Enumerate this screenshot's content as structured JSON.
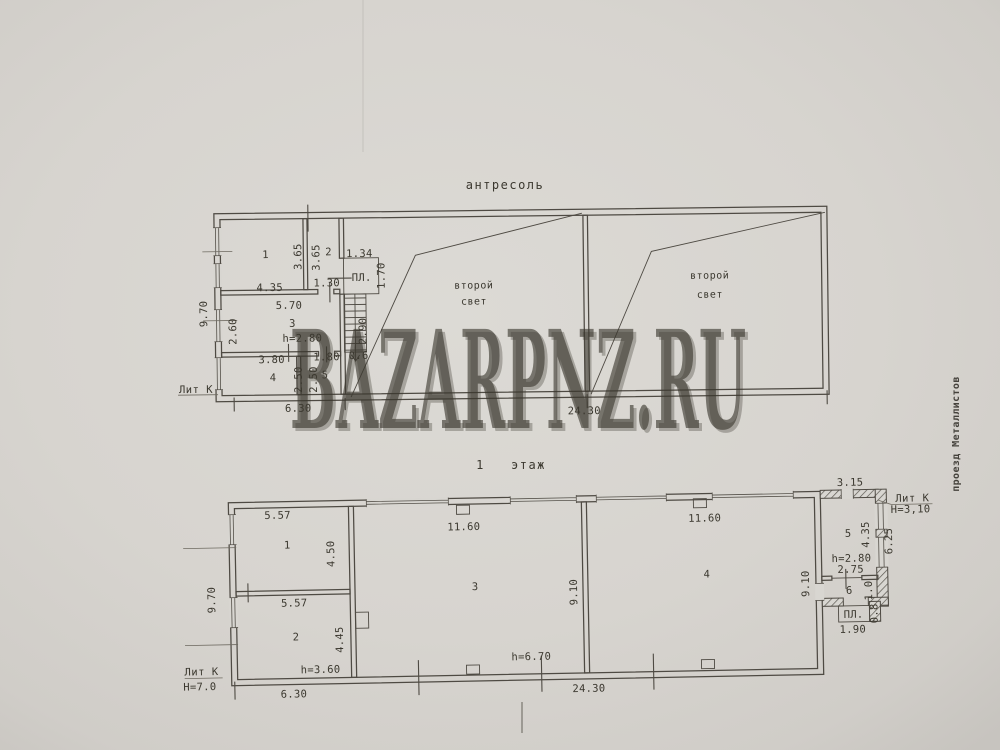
{
  "watermark": "BAZARPNZ.RU",
  "street_label": "проезд Металлистов",
  "mezzanine": {
    "title": "антресоль",
    "lit": "Лит К",
    "pl_label": "ПЛ.",
    "area1_line1": "второй",
    "area1_line2": "свет",
    "area2_line1": "второй",
    "area2_line2": "свет",
    "rooms": {
      "r1": "1",
      "r2": "2",
      "r3": "3",
      "r4": "4",
      "r5": "5"
    },
    "dims": {
      "left_height": "9.70",
      "bottom_left": "6.30",
      "bottom_right": "24.30",
      "r1_w": "4.35",
      "r1_h": "3.65",
      "r2_h": "3.65",
      "r2_w": "1.30",
      "pl_w": "1.34",
      "pl_h": "1.70",
      "stair_h": "2.90",
      "stair_w": "0.6",
      "r3_w": "5.70",
      "r3_d": "2.60",
      "r3_ceil": "h=2.80",
      "r4_w": "3.80",
      "r4_d": "2.50",
      "r5_w": "1.80",
      "r5_d": "2.50"
    }
  },
  "first_floor": {
    "title": "1   этаж",
    "lit_left": "Лит К",
    "h_left": "Н=7.0",
    "lit_right": "Лит К",
    "h_right": "Н=3,10",
    "pl_label": "ПЛ.",
    "rooms": {
      "r1": "1",
      "r2": "2",
      "r3": "3",
      "r4": "4",
      "r5": "5",
      "r6": "6"
    },
    "dims": {
      "left_height": "9.70",
      "bottom_left": "6.30",
      "bottom_right": "24.30",
      "r1_w": "5.57",
      "r1_d": "4.50",
      "r2_w": "5.57",
      "r2_d": "4.45",
      "r2_ceil": "h=3.60",
      "r3_w": "11.60",
      "r3_d": "9.10",
      "r4_w": "11.60",
      "r4_d": "9.10",
      "hall_ceil": "h=6.70",
      "ext_top": "3.15",
      "ext_right": "6.25",
      "r5_d": "4.35",
      "r5_ceil": "h=2.80",
      "r5_w": "2.75",
      "r6_d": "1.0",
      "pl_w": "1.90",
      "pl_d": "0.8"
    }
  }
}
